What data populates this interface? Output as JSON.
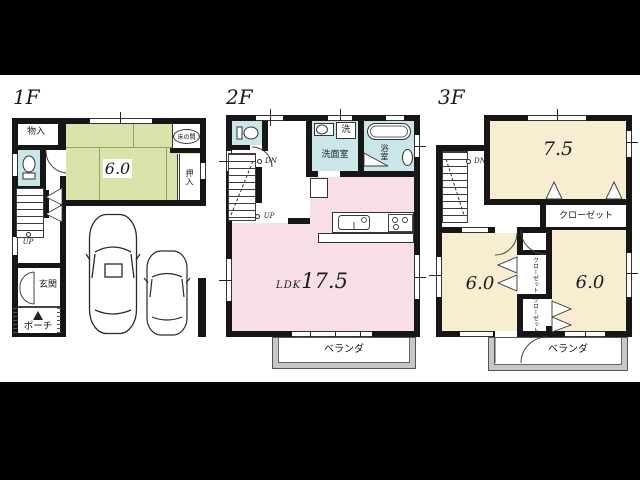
{
  "floors": [
    {
      "id": "1f",
      "label": "1F",
      "rooms": {
        "storage": "物入",
        "tatami_area": "6.0",
        "tokonoma": "床の間",
        "oshiire": "押入",
        "entrance": "玄関",
        "porch": "ポーチ",
        "stairs_up": "UP"
      }
    },
    {
      "id": "2f",
      "label": "2F",
      "rooms": {
        "washroom": "洗面室",
        "laundry": "洗",
        "bathroom": "浴室",
        "ldk_label": "LDK",
        "ldk_area": "17.5",
        "veranda": "ベランダ",
        "stairs_down": "DN",
        "stairs_up": "UP"
      }
    },
    {
      "id": "3f",
      "label": "3F",
      "rooms": {
        "bedroom_a_area": "7.5",
        "closet": "クローゼット",
        "bedroom_b_area": "6.0",
        "bedroom_c_area": "6.0",
        "closet_small_top": "クローゼット",
        "closet_small_bottom": "クローゼット",
        "veranda": "ベランダ",
        "stairs_down": "DN"
      }
    }
  ],
  "colors": {
    "tatami": "#d8e4aa",
    "wet_area": "#c9e6e9",
    "ldk": "#f8dfe7",
    "bedroom": "#f8ecd1",
    "veranda": "#c7c7c7",
    "wall": "#161616",
    "background": "#000000",
    "paper": "#ffffff"
  }
}
